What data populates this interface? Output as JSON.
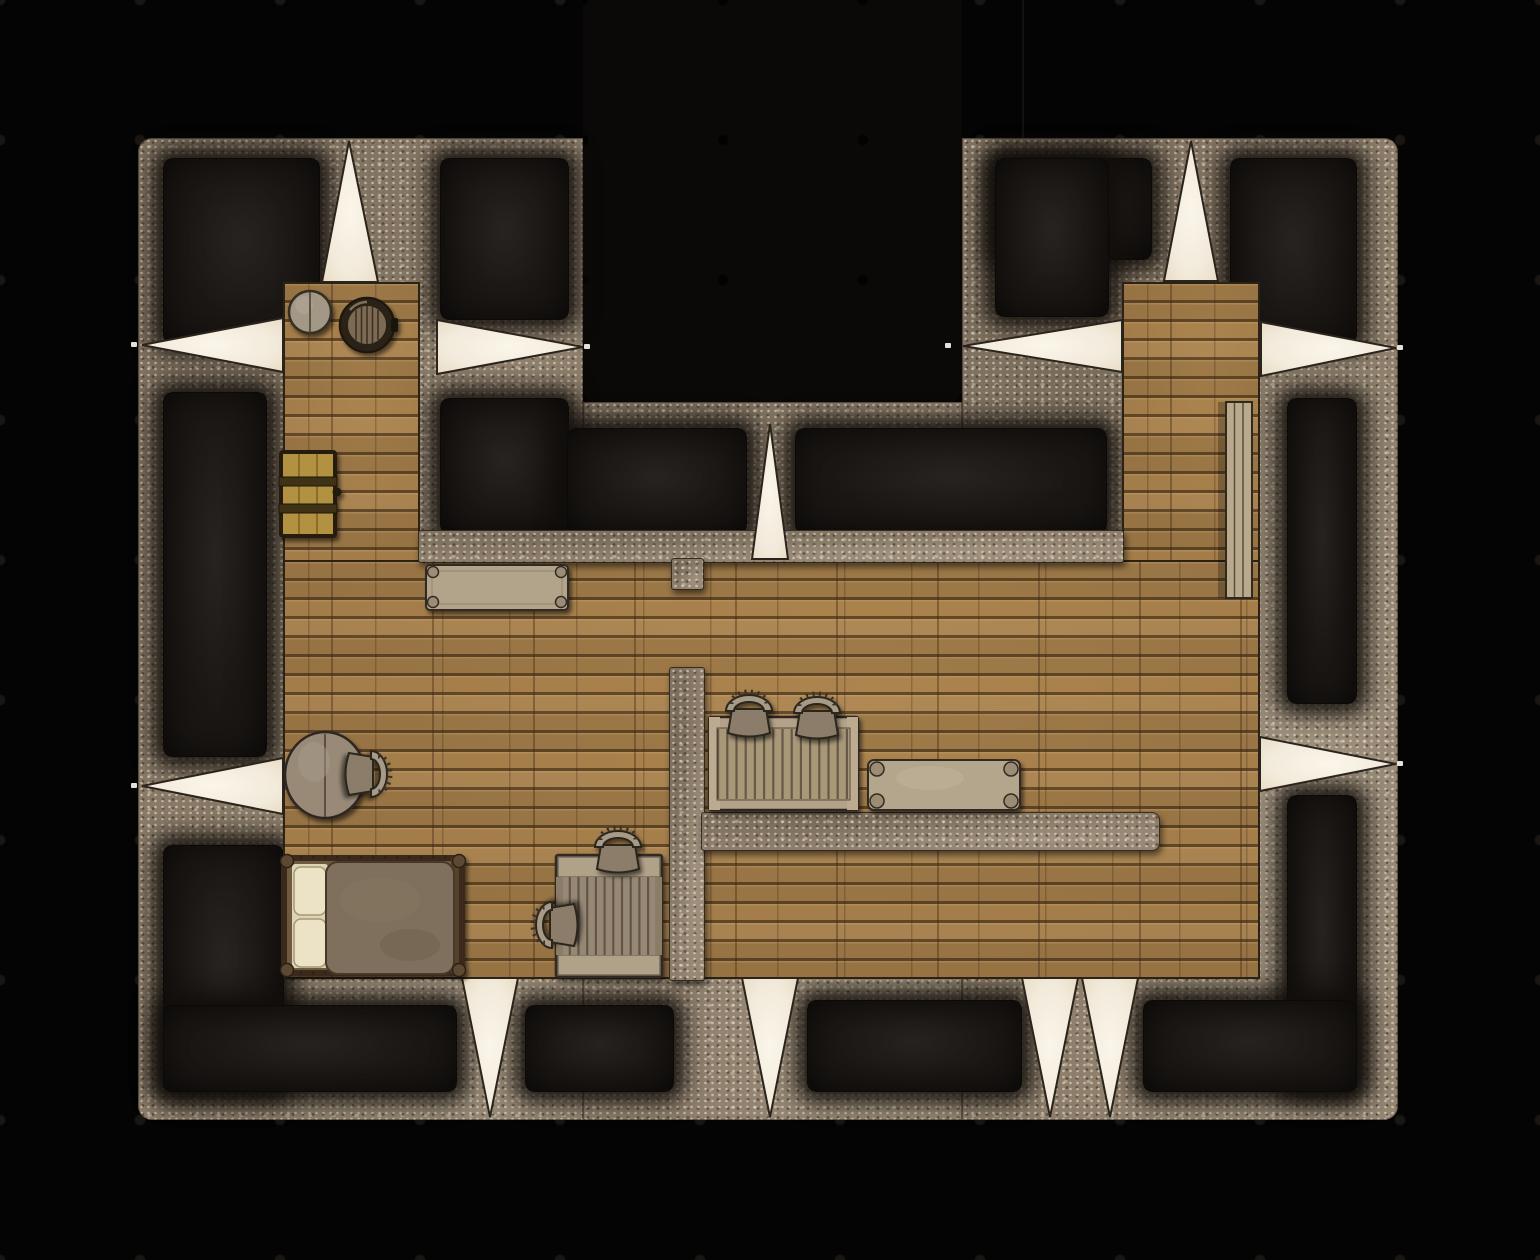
{
  "meta": {
    "description": "Top-down fantasy battle-map floor plan: stone building with wooden floors, dark unlit chambers, white light-slit beams in the walls, and simple furniture. No text is rendered in the image.",
    "visible_text": []
  },
  "canvas": {
    "width": 1540,
    "height": 1260,
    "background": "#040404"
  },
  "grid": {
    "cell_px": 140,
    "cols": 11,
    "rows": 9,
    "dot_color": "#191613"
  },
  "palette": {
    "background_black": "#040404",
    "notch_black": "#0a0908",
    "stone_wall": "#8d7e6b",
    "stone_speckle_light": "#fcf3df",
    "stone_speckle_dark": "#322a20",
    "dark_room": "#1b1714",
    "wood_floor": "#a27c49",
    "wood_seam": "#291909",
    "light_beam": "#f3ecdd",
    "furniture_light": "#b3a289",
    "furniture_mid": "#978874",
    "bed_blanket": "#7e6f5b",
    "bed_pillow": "#ece3c6",
    "cabinet_wood": "#b2913f"
  },
  "structure": {
    "stone_plates": [
      {
        "name": "left-block",
        "x": 138,
        "y": 138,
        "w": 445,
        "h": 982
      },
      {
        "name": "center-bottom-block",
        "x": 583,
        "y": 402,
        "w": 379,
        "h": 718
      },
      {
        "name": "right-block",
        "x": 962,
        "y": 138,
        "w": 436,
        "h": 982
      }
    ],
    "black_notch": {
      "x": 583,
      "y": 0,
      "w": 379,
      "h": 402
    },
    "dark_rooms": [
      {
        "name": "top-left",
        "x": 163,
        "y": 158,
        "w": 155,
        "h": 184
      },
      {
        "name": "upper-mid-left-a",
        "x": 440,
        "y": 158,
        "w": 127,
        "h": 160
      },
      {
        "name": "upper-mid-left-b",
        "x": 440,
        "y": 398,
        "w": 127,
        "h": 134
      },
      {
        "name": "below-notch-left",
        "x": 567,
        "y": 428,
        "w": 178,
        "h": 104
      },
      {
        "name": "below-notch-right",
        "x": 795,
        "y": 428,
        "w": 310,
        "h": 104
      },
      {
        "name": "top-right-inner-a",
        "x": 995,
        "y": 158,
        "w": 155,
        "h": 100
      },
      {
        "name": "top-right-inner-b",
        "x": 995,
        "y": 158,
        "w": 112,
        "h": 157
      },
      {
        "name": "top-right-outer",
        "x": 1230,
        "y": 158,
        "w": 125,
        "h": 184
      },
      {
        "name": "right-mid",
        "x": 1287,
        "y": 398,
        "w": 68,
        "h": 304
      },
      {
        "name": "right-lower",
        "x": 1287,
        "y": 795,
        "w": 68,
        "h": 295
      },
      {
        "name": "bottom-right",
        "x": 1143,
        "y": 1000,
        "w": 212,
        "h": 90
      },
      {
        "name": "left-mid",
        "x": 163,
        "y": 392,
        "w": 102,
        "h": 363
      },
      {
        "name": "bottom-left-arm",
        "x": 163,
        "y": 845,
        "w": 119,
        "h": 245
      },
      {
        "name": "bottom-left-wide",
        "x": 163,
        "y": 1005,
        "w": 292,
        "h": 85
      },
      {
        "name": "bottom-mid-left",
        "x": 525,
        "y": 1005,
        "w": 147,
        "h": 85
      },
      {
        "name": "bottom-mid",
        "x": 807,
        "y": 1000,
        "w": 213,
        "h": 90
      }
    ],
    "wood_floors": [
      {
        "name": "left-tower-room",
        "x": 283,
        "y": 282,
        "w": 137,
        "h": 282
      },
      {
        "name": "main-hall",
        "x": 283,
        "y": 560,
        "w": 977,
        "h": 419
      },
      {
        "name": "right-tower-room",
        "x": 1122,
        "y": 282,
        "w": 138,
        "h": 282
      }
    ],
    "inner_walls": [
      {
        "name": "hall-top-wall",
        "x": 418,
        "y": 530,
        "w": 704,
        "h": 31
      },
      {
        "name": "door-stub",
        "x": 671,
        "y": 558,
        "w": 31,
        "h": 30
      },
      {
        "name": "partition-wall",
        "x": 669,
        "y": 667,
        "w": 34,
        "h": 312
      },
      {
        "name": "stone-counter",
        "x": 701,
        "y": 812,
        "w": 457,
        "h": 37
      }
    ],
    "door_gap": {
      "x": 671,
      "y": 588,
      "w": 31,
      "h": 79
    }
  },
  "light_slits": [
    {
      "name": "top-left-vertical",
      "base": [
        [
          322,
          282
        ],
        [
          378,
          282
        ]
      ],
      "apex": [
        349,
        141
      ]
    },
    {
      "name": "top-right-vertical",
      "base": [
        [
          1164,
          281
        ],
        [
          1218,
          281
        ]
      ],
      "apex": [
        1191,
        141
      ]
    },
    {
      "name": "mid-vertical-below-notch",
      "base": [
        [
          752,
          559
        ],
        [
          788,
          559
        ]
      ],
      "apex": [
        770,
        424
      ]
    },
    {
      "name": "left-wall-upper",
      "base": [
        [
          283,
          318
        ],
        [
          283,
          372
        ]
      ],
      "apex": [
        142,
        345
      ]
    },
    {
      "name": "left-wall-lower",
      "base": [
        [
          283,
          758
        ],
        [
          283,
          814
        ]
      ],
      "apex": [
        142,
        786
      ]
    },
    {
      "name": "notch-left",
      "base": [
        [
          437,
          320
        ],
        [
          437,
          374
        ]
      ],
      "apex": [
        583,
        347
      ]
    },
    {
      "name": "notch-right",
      "base": [
        [
          1122,
          320
        ],
        [
          1122,
          372
        ]
      ],
      "apex": [
        963,
        346
      ]
    },
    {
      "name": "right-wall-upper",
      "base": [
        [
          1261,
          322
        ],
        [
          1261,
          376
        ]
      ],
      "apex": [
        1396,
        348
      ]
    },
    {
      "name": "right-wall-lower",
      "base": [
        [
          1260,
          737
        ],
        [
          1260,
          791
        ]
      ],
      "apex": [
        1396,
        764
      ]
    },
    {
      "name": "bottom-1",
      "base": [
        [
          462,
          978
        ],
        [
          518,
          978
        ]
      ],
      "apex": [
        490,
        1117
      ]
    },
    {
      "name": "bottom-2",
      "base": [
        [
          742,
          978
        ],
        [
          798,
          978
        ]
      ],
      "apex": [
        770,
        1117
      ]
    },
    {
      "name": "bottom-3",
      "base": [
        [
          1022,
          978
        ],
        [
          1078,
          978
        ]
      ],
      "apex": [
        1050,
        1117
      ]
    },
    {
      "name": "bottom-4",
      "base": [
        [
          1082,
          978
        ],
        [
          1138,
          978
        ]
      ],
      "apex": [
        1110,
        1117
      ]
    }
  ],
  "furniture": [
    {
      "type": "grindstone",
      "cx": 310,
      "cy": 312,
      "r": 21
    },
    {
      "type": "barrel",
      "cx": 367,
      "cy": 325,
      "r": 27
    },
    {
      "type": "cabinet",
      "x": 281,
      "y": 452,
      "w": 54,
      "h": 84
    },
    {
      "type": "table-long",
      "x": 426,
      "y": 565,
      "w": 142,
      "h": 45
    },
    {
      "type": "table-round",
      "cx": 325,
      "cy": 775,
      "rx": 40,
      "ry": 43
    },
    {
      "type": "chair",
      "cx": 376,
      "cy": 774,
      "facing": "left"
    },
    {
      "type": "bed",
      "x": 281,
      "y": 855,
      "w": 184,
      "h": 121
    },
    {
      "type": "desk-slatted",
      "x": 556,
      "y": 855,
      "w": 106,
      "h": 122
    },
    {
      "type": "chair",
      "cx": 618,
      "cy": 842,
      "facing": "down"
    },
    {
      "type": "chair",
      "cx": 547,
      "cy": 925,
      "facing": "right"
    },
    {
      "type": "crate-table",
      "x": 709,
      "y": 717,
      "w": 149,
      "h": 93
    },
    {
      "type": "chair",
      "cx": 749,
      "cy": 706,
      "facing": "down"
    },
    {
      "type": "chair",
      "cx": 817,
      "cy": 708,
      "facing": "down"
    },
    {
      "type": "bench",
      "x": 868,
      "y": 760,
      "w": 152,
      "h": 50
    },
    {
      "type": "shelf",
      "x": 1226,
      "y": 402,
      "w": 26,
      "h": 196
    }
  ]
}
